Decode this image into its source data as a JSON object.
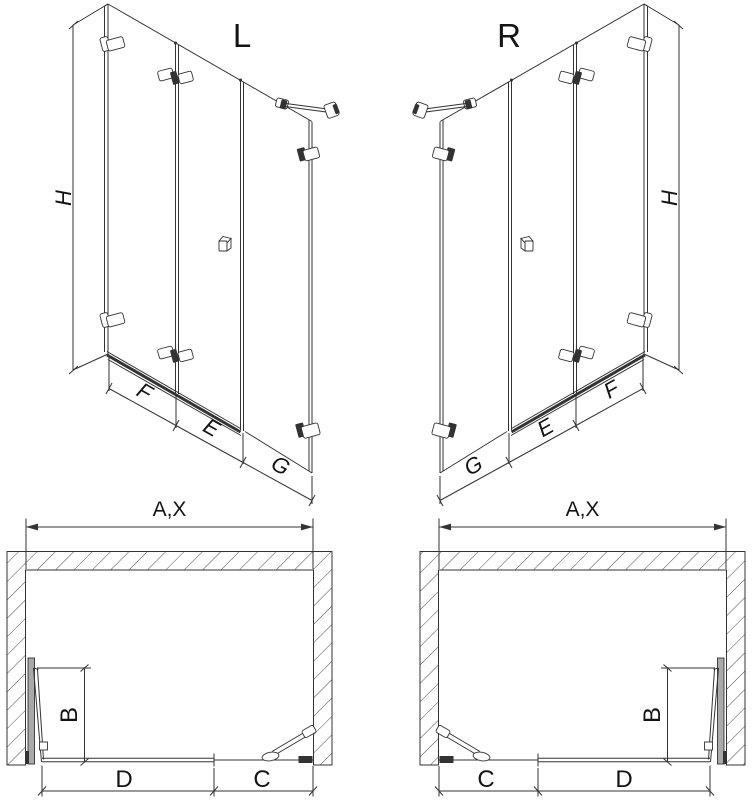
{
  "colors": {
    "line": "#333333",
    "text": "#141414",
    "hatch": "#4a4a4a",
    "wall_profile_gray": "#a9a9a9",
    "background": "#ffffff"
  },
  "elevation_left": {
    "heading": "L",
    "height_label": "H",
    "width_labels": [
      "F",
      "E",
      "G"
    ]
  },
  "elevation_right": {
    "heading": "R",
    "height_label": "H",
    "width_labels": [
      "G",
      "E",
      "F"
    ]
  },
  "plan_left": {
    "overall_width_label": "A,X",
    "door_projection_label": "B",
    "segment_labels": [
      "D",
      "C"
    ]
  },
  "plan_right": {
    "overall_width_label": "A,X",
    "door_projection_label": "B",
    "segment_labels": [
      "C",
      "D"
    ]
  }
}
